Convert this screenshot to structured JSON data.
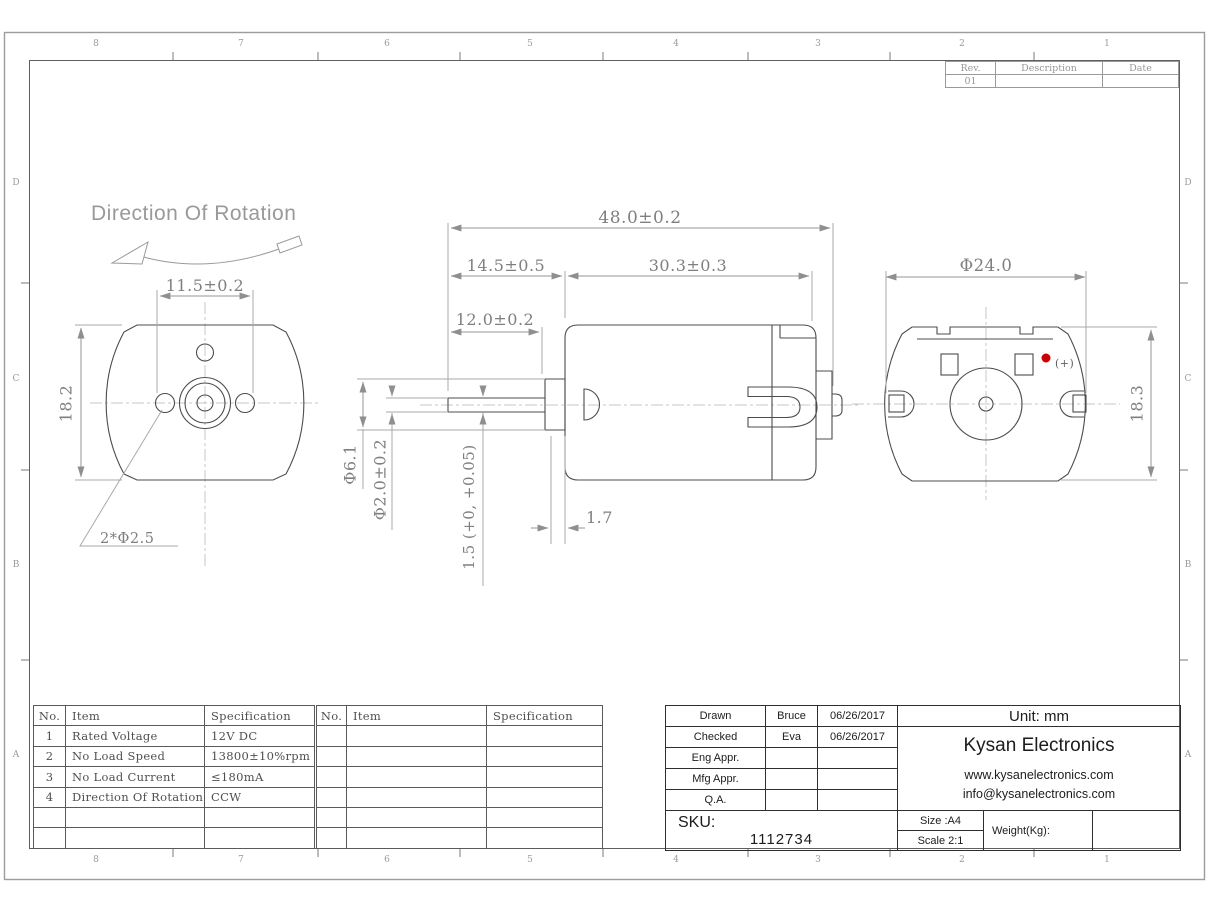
{
  "sheet": {
    "zone_columns": [
      "8",
      "7",
      "6",
      "5",
      "4",
      "3",
      "2",
      "1"
    ],
    "zone_rows": [
      "D",
      "C",
      "B",
      "A"
    ],
    "revision_table": {
      "col_rev": "Rev.",
      "col_desc": "Description",
      "col_date": "Date",
      "rev_value": "01"
    }
  },
  "front_view": {
    "title": "Direction Of Rotation",
    "dim_hole_spacing": "11.5±0.2",
    "dim_height": "18.2",
    "dim_mount_holes": "2*Φ2.5"
  },
  "side_view": {
    "dim_total_length": "48.0±0.2",
    "dim_front_length": "14.5±0.5",
    "dim_body_length": "30.3±0.3",
    "dim_shaft_length": "12.0±0.2",
    "dim_boss_dia": "Φ6.1",
    "dim_shaft_dia": "Φ2.0±0.2",
    "dim_shaft_flat": "1.5 (+0, +0.05)",
    "dim_boss_protrusion": "1.7"
  },
  "rear_view": {
    "dim_width": "Φ24.0",
    "dim_height": "18.3",
    "polarity_label": "(+)",
    "polarity_dot_color": "#cc0000"
  },
  "spec_table": {
    "headers": {
      "no": "No.",
      "item": "Item",
      "spec": "Specification"
    },
    "rows": [
      {
        "no": "1",
        "item": "Rated Voltage",
        "spec": "12V DC"
      },
      {
        "no": "2",
        "item": "No Load Speed",
        "spec": "13800±10%rpm"
      },
      {
        "no": "3",
        "item": "No Load Current",
        "spec": "≤180mA"
      },
      {
        "no": "4",
        "item": "Direction Of Rotation",
        "spec": "CCW"
      }
    ]
  },
  "approval_block": {
    "rows": [
      {
        "label": "Drawn",
        "name": "Bruce",
        "date": "06/26/2017"
      },
      {
        "label": "Checked",
        "name": "Eva",
        "date": "06/26/2017"
      },
      {
        "label": "Eng Appr.",
        "name": "",
        "date": ""
      },
      {
        "label": "Mfg Appr.",
        "name": "",
        "date": ""
      },
      {
        "label": "Q.A.",
        "name": "",
        "date": ""
      }
    ]
  },
  "title_block": {
    "unit": "Unit: mm",
    "company": "Kysan Electronics",
    "website": "www.kysanelectronics.com",
    "email": "info@kysanelectronics.com",
    "sku_label": "SKU:",
    "sku_number": "1112734",
    "size": "Size :A4",
    "scale": "Scale 2:1",
    "weight": "Weight(Kg):"
  }
}
